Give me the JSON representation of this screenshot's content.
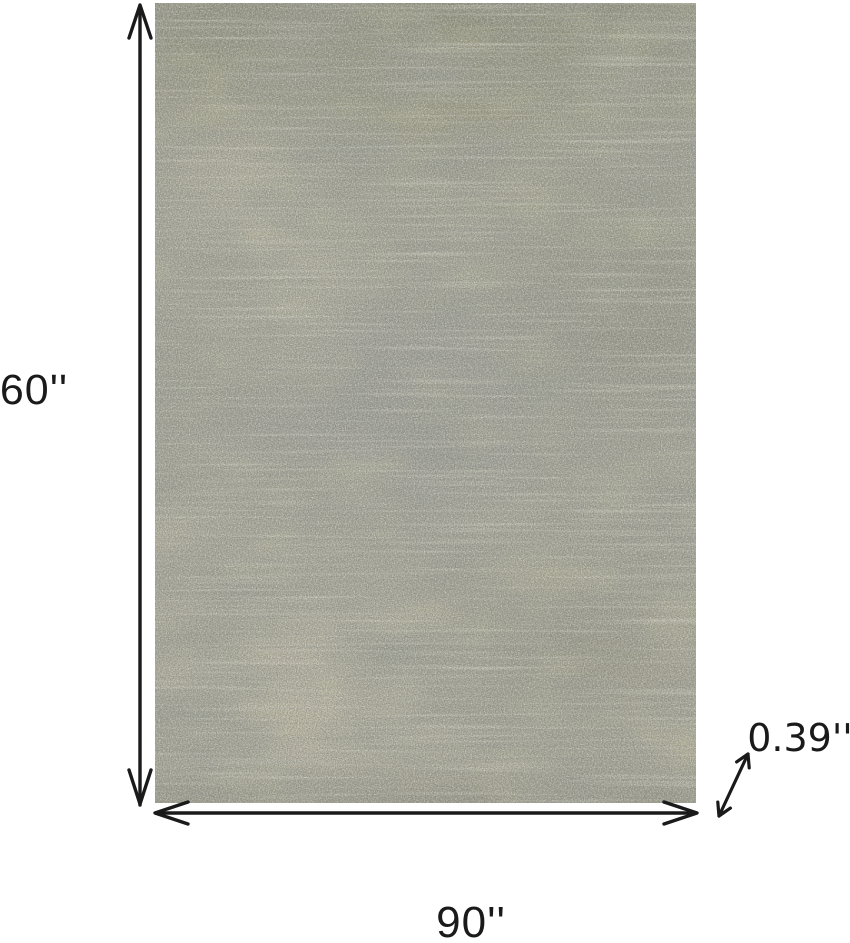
{
  "diagram": {
    "height_label": "60''",
    "width_label": "90''",
    "thickness_label": "0.39''"
  },
  "rug": {
    "description": "abstract-textured-area-rug",
    "colors": {
      "base": "#aba99a",
      "light": "#cdc8b4",
      "mid_gray": "#9e9d93",
      "dark": "#55564c",
      "olive": "#8f8c63",
      "blue_gray": "#8e939c"
    }
  },
  "colors": {
    "background": "#ffffff",
    "dimension_ink": "#1a1a1a"
  }
}
